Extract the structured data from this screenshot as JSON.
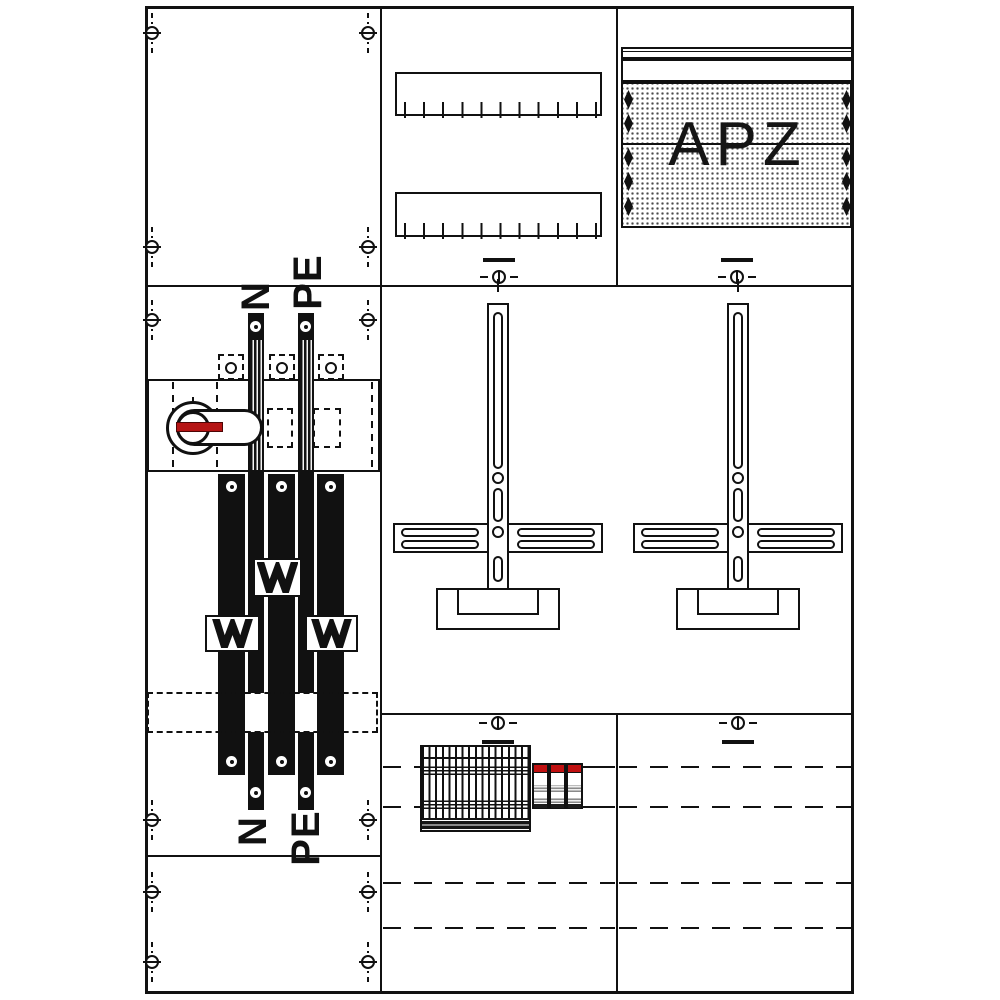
{
  "diagram": {
    "busbar_section": {
      "label_n_top": "N",
      "label_pe_top": "PE",
      "label_n_bottom": "N",
      "label_pe_bottom": "PE"
    },
    "apz_section": {
      "label": "APZ"
    },
    "colors": {
      "line": "#111111",
      "background": "#ffffff",
      "switch_handle_red": "#b51414",
      "breaker_cap_red": "#c01010",
      "perforation_dots": "#4a4a4a"
    }
  }
}
